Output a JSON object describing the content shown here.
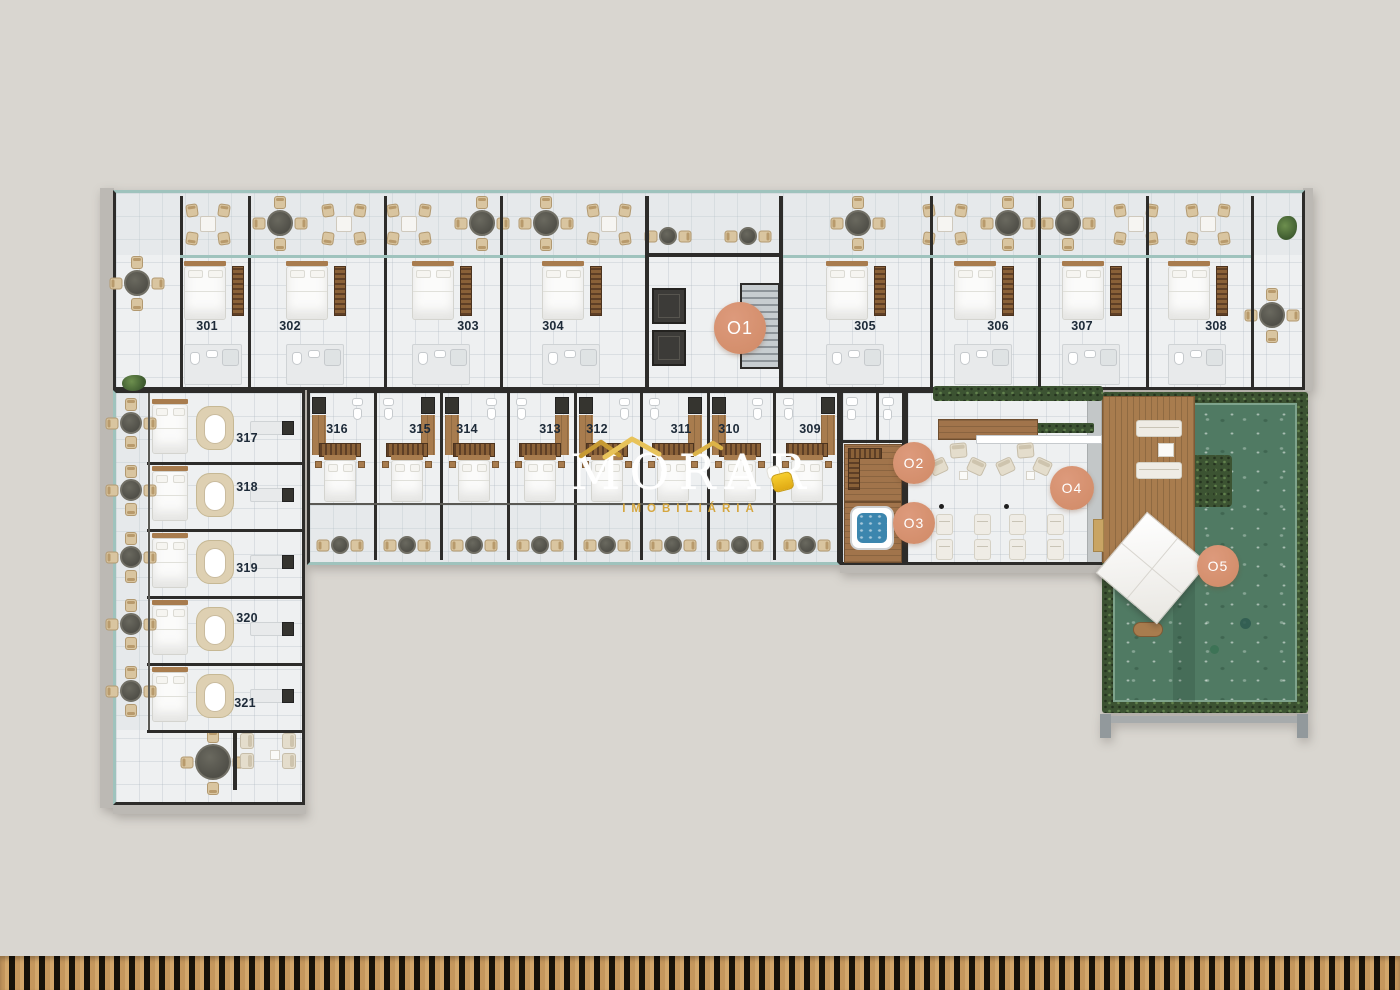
{
  "brand": {
    "name": "MORAR",
    "subtitle": "IMOBILIÁRIA",
    "house_icon": "house-roof-icon",
    "chair_icon": "armchair-icon"
  },
  "floorplan": {
    "unit_labels": [
      {
        "number": "301",
        "x": 207,
        "y": 326
      },
      {
        "number": "302",
        "x": 290,
        "y": 326
      },
      {
        "number": "303",
        "x": 468,
        "y": 326
      },
      {
        "number": "304",
        "x": 553,
        "y": 326
      },
      {
        "number": "305",
        "x": 865,
        "y": 326
      },
      {
        "number": "306",
        "x": 998,
        "y": 326
      },
      {
        "number": "307",
        "x": 1082,
        "y": 326
      },
      {
        "number": "308",
        "x": 1216,
        "y": 326
      },
      {
        "number": "309",
        "x": 810,
        "y": 429
      },
      {
        "number": "310",
        "x": 729,
        "y": 429
      },
      {
        "number": "311",
        "x": 681,
        "y": 429
      },
      {
        "number": "312",
        "x": 597,
        "y": 429
      },
      {
        "number": "313",
        "x": 550,
        "y": 429
      },
      {
        "number": "314",
        "x": 467,
        "y": 429
      },
      {
        "number": "315",
        "x": 420,
        "y": 429
      },
      {
        "number": "316",
        "x": 337,
        "y": 429
      },
      {
        "number": "317",
        "x": 247,
        "y": 438
      },
      {
        "number": "318",
        "x": 247,
        "y": 487
      },
      {
        "number": "319",
        "x": 247,
        "y": 568
      },
      {
        "number": "320",
        "x": 247,
        "y": 618
      },
      {
        "number": "321",
        "x": 245,
        "y": 703
      }
    ],
    "area_markers": [
      {
        "id": "O1",
        "x": 740,
        "y": 328,
        "r": 26,
        "font": 18
      },
      {
        "id": "O2",
        "x": 914,
        "y": 463,
        "r": 21,
        "font": 14
      },
      {
        "id": "O3",
        "x": 914,
        "y": 523,
        "r": 21,
        "font": 14
      },
      {
        "id": "O4",
        "x": 1072,
        "y": 488,
        "r": 22,
        "font": 14
      },
      {
        "id": "O5",
        "x": 1218,
        "y": 566,
        "r": 21,
        "font": 14
      }
    ]
  },
  "colors": {
    "background": "#d9d6d0",
    "marker": "#d69174",
    "marker_text": "#ffffff",
    "unit_label": "#1d2a38",
    "brand_text": "#ffffff",
    "brand_subtitle": "#d5a63e",
    "wall": "#2d2c2a",
    "grass": "#507a63",
    "hedge": "#3c5332",
    "wood": "#a87c4e",
    "jacuzzi_water": "#3c86ae"
  }
}
